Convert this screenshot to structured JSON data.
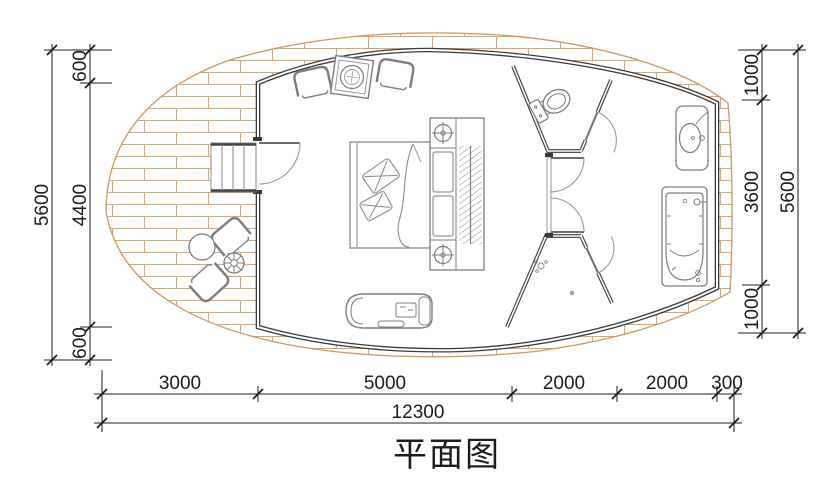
{
  "title": "平面图",
  "dimensions": {
    "left_outer": "5600",
    "left_chain": [
      "600",
      "4400",
      "600"
    ],
    "right_chain": [
      "1000",
      "3600",
      "1000"
    ],
    "right_outer": "5600",
    "bottom_chain": [
      "3000",
      "5000",
      "2000",
      "2000",
      "300"
    ],
    "bottom_total": "12300"
  },
  "legend": {
    "drawing_type": "floor-plan",
    "elements": [
      "deck",
      "stairs",
      "entry-door",
      "armchairs",
      "side-table",
      "bed",
      "nightstand-lamps",
      "wardrobe",
      "chaise",
      "toilet",
      "double-door",
      "shower",
      "floor-drain",
      "sink",
      "bathtub"
    ]
  },
  "colors": {
    "deck_line": "#e2a268",
    "deck_outline": "#d2955c",
    "wall": "#3a3a3a",
    "furniture": "#7d7d7d",
    "dimension": "#1c1c1c"
  }
}
